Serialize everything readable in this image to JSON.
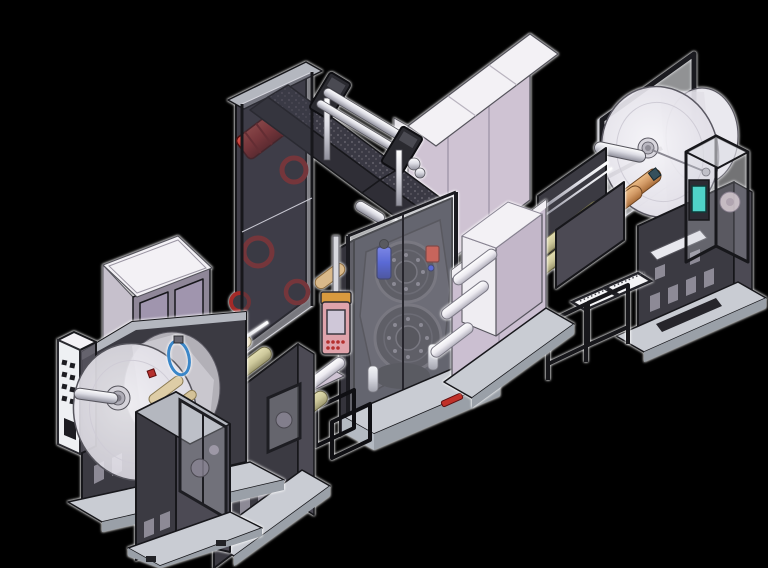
{
  "scene": {
    "type": "3d-cad-isometric-render",
    "description": "Isometric CAD rendering of a roll-to-roll web converting production line (unwinder, roller stands, press tower with drums, drying oven cabinets, rewinder) on a black background",
    "machines": [
      {
        "id": "unwind-station",
        "label": "Unwind station with material roll",
        "features": [
          "material-roll-disc",
          "roll-hub-shaft",
          "vent-grille-panel",
          "guard-window-column",
          "slotted-base",
          "floor-platform"
        ]
      },
      {
        "id": "infeed-roller-stand",
        "label": "Infeed web roller stand",
        "features": [
          "khaki-rollers",
          "chrome-idler-rollers",
          "guard-window",
          "slotted-base"
        ]
      },
      {
        "id": "electrical-cabinet",
        "label": "Electrical control cabinet",
        "features": [
          "double-doors",
          "white-top"
        ]
      },
      {
        "id": "hose-ring",
        "label": "Blue hose coil ring"
      },
      {
        "id": "process-tower",
        "label": "Rear process tower",
        "features": [
          "red-drive-motor",
          "red-rollers",
          "smoked-guard-panels",
          "textured-transfer-chute",
          "overhead-chrome-rails"
        ]
      },
      {
        "id": "press-unit",
        "label": "Front press / laminating unit",
        "features": [
          "upper-drum",
          "lower-drum",
          "blue-cylinder",
          "red-valve",
          "machine-base",
          "red-lever",
          "step-frame"
        ]
      },
      {
        "id": "hmi-pendant",
        "label": "Pink HMI pendant with screen and orange cap"
      },
      {
        "id": "oven-cabinet",
        "label": "Drying oven cabinets",
        "features": [
          "lavender-panels",
          "white-tops",
          "web-entry-chamber",
          "white-guide-rollers"
        ]
      },
      {
        "id": "outfeed-roller-stand",
        "label": "Outfeed roller stand",
        "features": [
          "khaki-rollers",
          "chrome-idler-rollers",
          "perforated-tables",
          "tube-bench"
        ]
      },
      {
        "id": "rewind-station",
        "label": "Rewind station with material roll",
        "features": [
          "material-roll-disc",
          "guard-frame",
          "orange-rollers",
          "control-box",
          "teal-screen",
          "slotted-body",
          "floor-platform"
        ]
      }
    ],
    "roller_counts": {
      "infeed_stand": 5,
      "outfeed_stand": 4,
      "oven_chamber_white": 3,
      "rewind_orange": 2
    }
  },
  "colors": {
    "background": "#000000",
    "halo": "#ffffff",
    "body_dark": "#3b3a42",
    "body_darker": "#34333b",
    "body_mid": "#4c4a54",
    "slot_light": "#8d8a96",
    "slot_dark": "#26252b",
    "base_light": "#c9ccd3",
    "base_mid": "#b4bac2",
    "base_edge": "#9aa0a8",
    "lavender": "#cfc3d3",
    "lavender_shade": "#c3b7c9",
    "lavender_deep": "#cbbfd1",
    "top_white": "#f3f1f5",
    "off_white": "#e9e7ec",
    "beam_gray": "#b4b7bf",
    "smoke_tint": "#3c3c46",
    "glass_tint": "#d5d8e0",
    "frame_black": "#17171b",
    "line_dark": "#55545c",
    "accent_red": "#b5302e",
    "valve_red": "#c23a2a",
    "accent_blue": "#2b3fd0",
    "teal_screen": "#4fd2c8",
    "hmi_pink": "#dfa3ab",
    "hmi_orange": "#d99a3e",
    "ring_blue": "#3a86c8",
    "khaki": "#cdc89b",
    "roll_orange": "#d29a66",
    "chrome": "#dcdce4",
    "disc_fill": "#eeecf2"
  }
}
